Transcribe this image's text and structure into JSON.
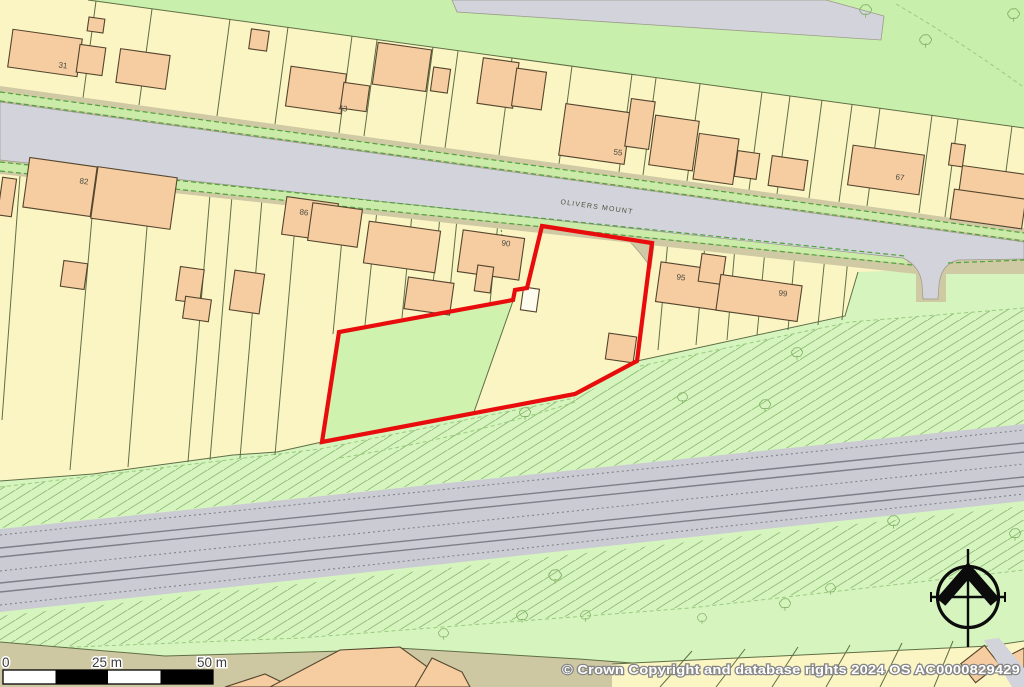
{
  "map": {
    "road_label": "OLIVERS MOUNT",
    "house_labels": [
      {
        "text": "31"
      },
      {
        "text": "43"
      },
      {
        "text": "55"
      },
      {
        "text": "67"
      },
      {
        "text": "82"
      },
      {
        "text": "86"
      },
      {
        "text": "90"
      },
      {
        "text": "95"
      },
      {
        "text": "99"
      }
    ],
    "scale_bar": {
      "tick_0": "0",
      "tick_25": "25 m",
      "tick_50": "50 m"
    },
    "copyright": "© Crown Copyright and database rights 2024 OS AC0000829429",
    "icons": {
      "north_arrow": "compass-north-arrow-icon",
      "tree": "deciduous-tree-icon"
    },
    "colors": {
      "parcel_yellow": "#FBF5C4",
      "building_peach": "#F5CDA0",
      "building_outline": "#54452E",
      "green_top": "#C9EFAC",
      "green_bottom": "#D5F4BE",
      "plot_paddock_green": "#CFF2AE",
      "road_grey": "#D3D3DC",
      "railway_grey": "#CBCBD3",
      "verge_tan": "#CFC9A4",
      "boundary_red": "#E80C0C",
      "parcel_line_olive": "#5F6F45",
      "hatch_green": "#8FBA74"
    }
  }
}
